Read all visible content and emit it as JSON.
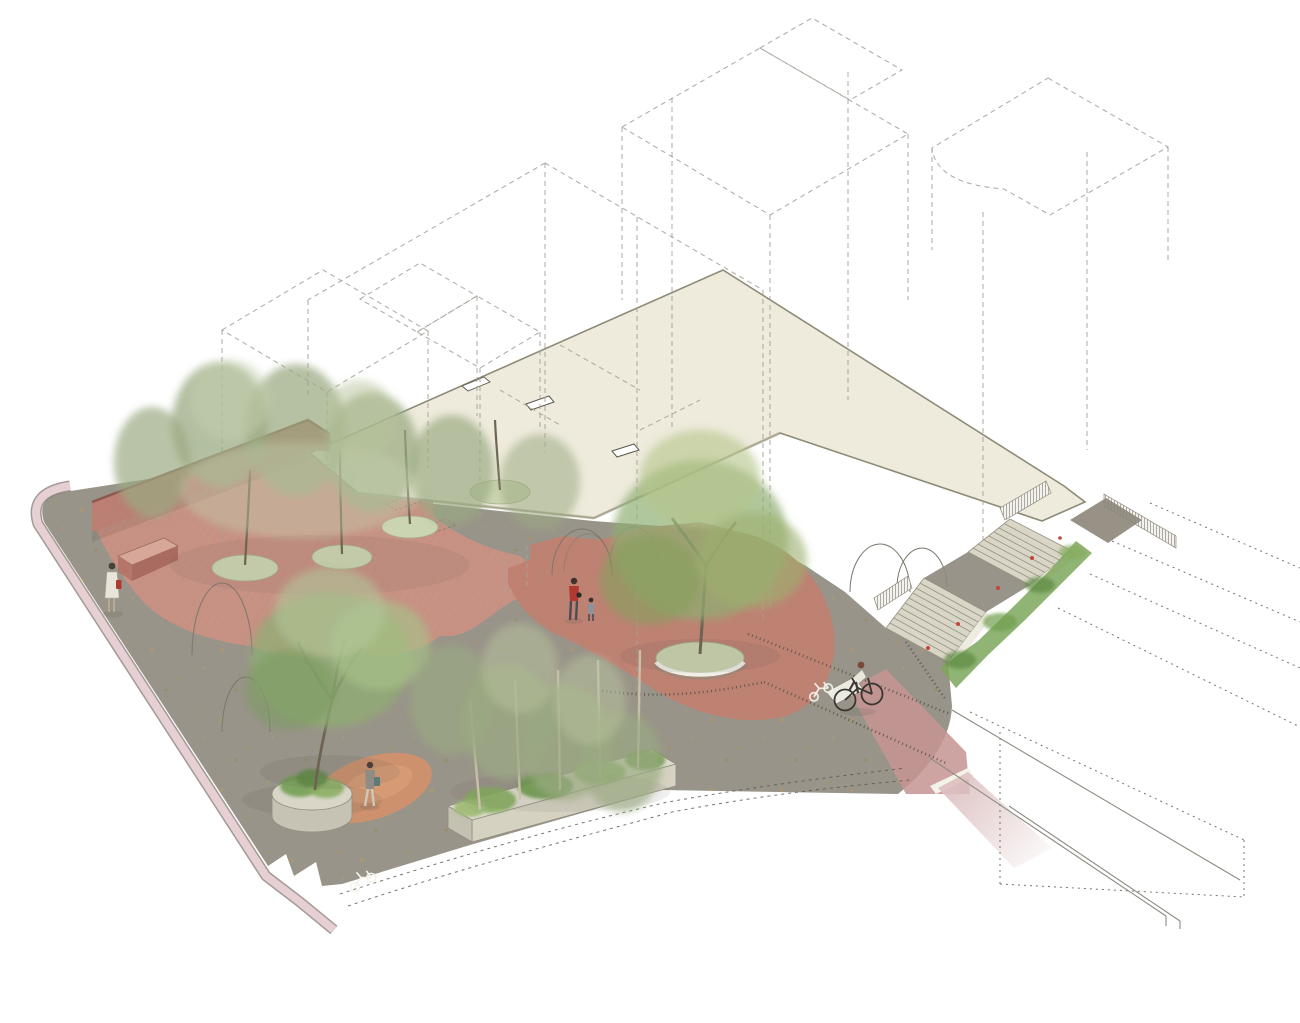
{
  "scene": {
    "view": "axonometric-site-illustration",
    "content": "street corner public-realm design: dashed building volumes, elevated cream deck, brick plazas, shared street, stairs with planting, bike lane",
    "pedestrian_count": 4,
    "cyclist_count": 1,
    "bike_stencil_count": 2,
    "stair_flight_count": 2,
    "tree_pit_count": 4,
    "planter_count": 2,
    "deck_opening_count": 2
  },
  "palette": {
    "background": "#ffffff",
    "dashed_line": "#a6a29a",
    "deck_cream": "#eeebdb",
    "deck_edge": "#8a8874",
    "asphalt": "#8e887c",
    "curb_pink": "#e6d0d4",
    "curb_line": "#8b8178",
    "terrace_brick": "#c99184",
    "wall_brick": "#bb7f74",
    "wall_top": "#8f564e",
    "plaza_terracotta": "#c08172",
    "patch_orange": "#d3906c",
    "bikeway_red": "#c59493",
    "bikeway_pink": "#ddc1c1",
    "concrete": "#d9d5c7",
    "planter_concrete": "#d6d2c2",
    "pit_sage": "#ccd5b1",
    "tree_olive": "#9aa981",
    "tree_green": "#8fae72",
    "tree_green_light": "#b2c49a",
    "shrub_green": "#7da75c",
    "flower_red": "#c2473a",
    "trunk_brown": "#6f6453",
    "birch_trunk": "#c9c0aa",
    "texture_dot": "#55524a",
    "arch_line": "#7b776c",
    "figure_red": "#b03a31",
    "figure_slate": "#8794a1",
    "figure_teal": "#5d7a77",
    "white_marking": "#f4f3ea"
  }
}
